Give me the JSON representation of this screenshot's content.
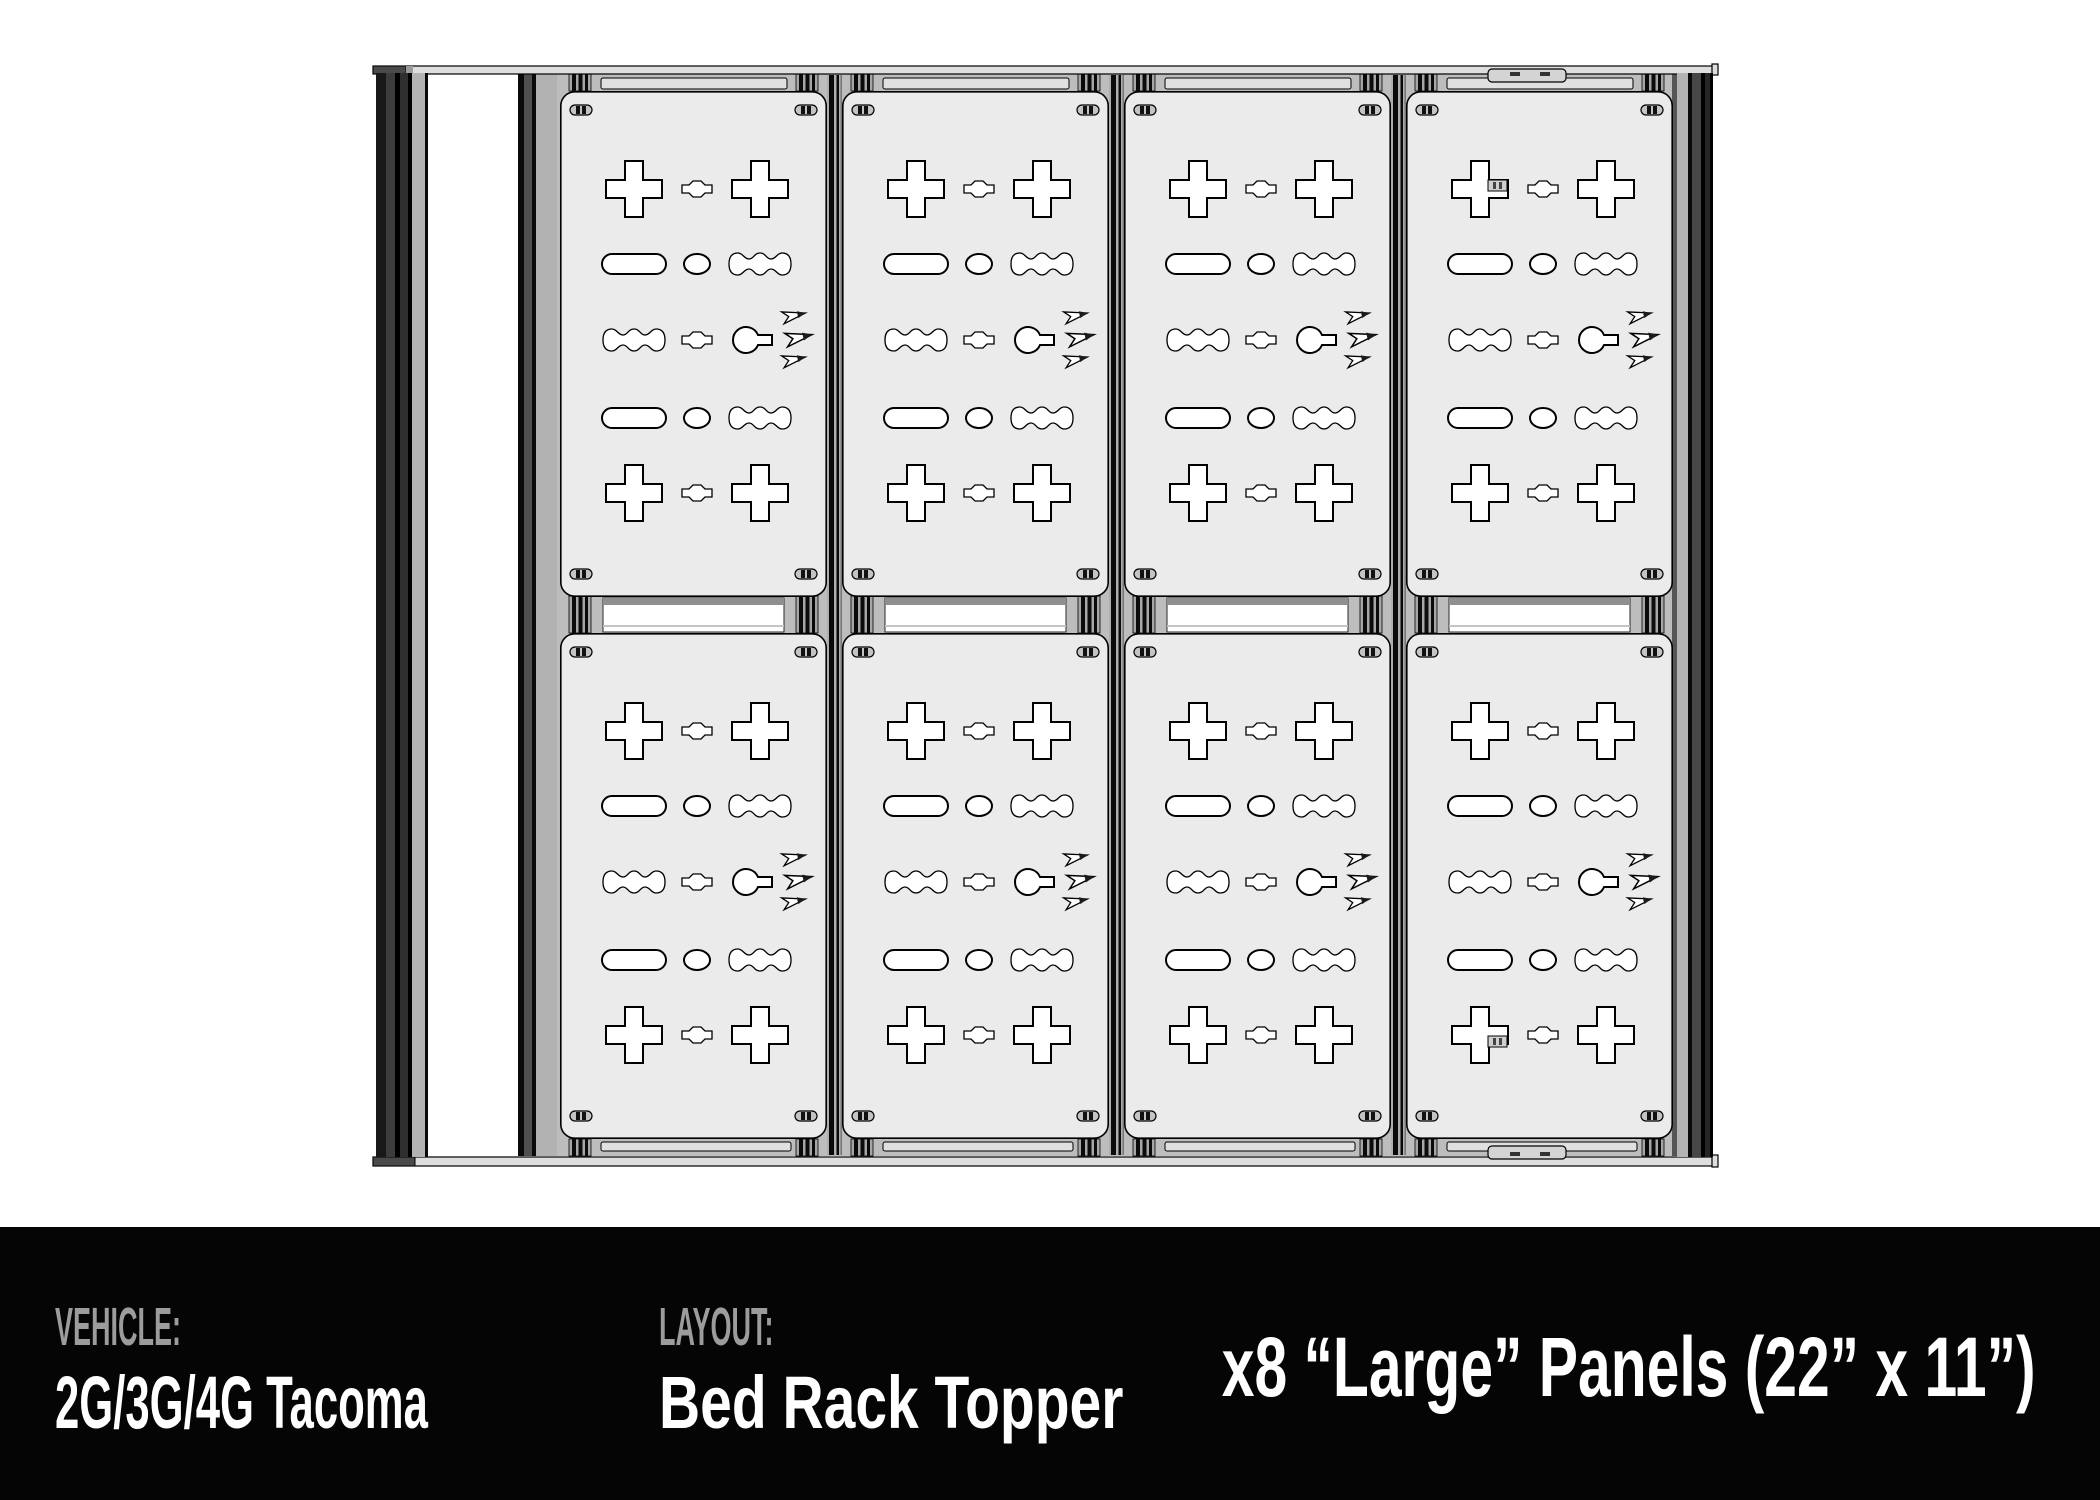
{
  "footer": {
    "vehicle_label": "VEHICLE:",
    "vehicle_value": "2G/3G/4G Tacoma",
    "layout_label": "LAYOUT:",
    "layout_value": "Bed Rack Topper",
    "panels_summary": "x8 “Large” Panels (22” x 11”)",
    "background": "#050505",
    "label_color": "#9c9c9c",
    "text_color": "#ffffff"
  },
  "diagram": {
    "view": "top-down line drawing of bed rack topper",
    "panel_count": 8,
    "grid_columns": 4,
    "grid_rows": 2,
    "panel_fill": "#ebebeb",
    "cutout_fill": "#ffffff",
    "outline_color": "#000000",
    "deck_color": "#bdbdbd",
    "icons": {
      "panel_logo": "mountain-logo-icon"
    }
  }
}
